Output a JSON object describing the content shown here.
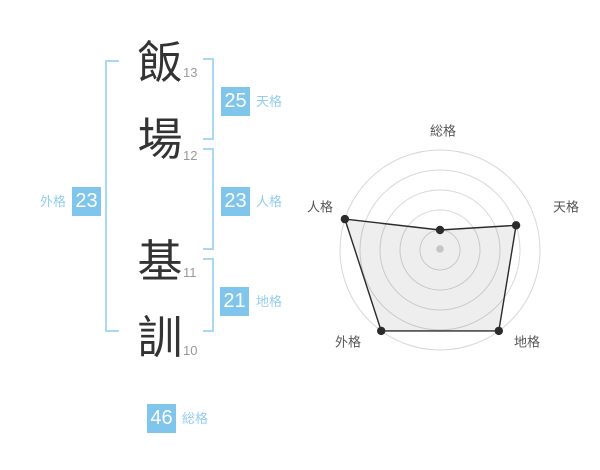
{
  "name_analysis": {
    "chars": [
      {
        "char": "飯",
        "strokes": "13"
      },
      {
        "char": "場",
        "strokes": "12"
      },
      {
        "char": "基",
        "strokes": "11"
      },
      {
        "char": "訓",
        "strokes": "10"
      }
    ],
    "badges": {
      "tenkaku": {
        "value": "25",
        "label": "天格"
      },
      "jinkaku": {
        "value": "23",
        "label": "人格"
      },
      "chikaku": {
        "value": "21",
        "label": "地格"
      },
      "gaikaku": {
        "value": "23",
        "label": "外格"
      },
      "soukaku": {
        "value": "46",
        "label": "総格"
      }
    }
  },
  "colors": {
    "badge_blue": "#7fc5ec",
    "bracket_blue": "#a9d8f3",
    "label_blue": "#94cdf0",
    "kanji_dark": "#333333",
    "stroke_gray": "#999999",
    "ring_gray": "#d8d8d8",
    "chart_dark": "#2b2b2b",
    "chart_fill": "rgba(0,0,0,0.065)",
    "axis_label_gray": "#555555",
    "center_dot_gray": "#c6c6c6"
  },
  "chart_data": {
    "type": "radar",
    "axes": [
      "総格",
      "天格",
      "地格",
      "外格",
      "人格"
    ],
    "values": [
      1,
      4,
      5,
      5,
      5
    ],
    "max": 5,
    "rings": 5,
    "grid": "concentric-circles",
    "legend": "none",
    "center_dot": true,
    "title": ""
  }
}
